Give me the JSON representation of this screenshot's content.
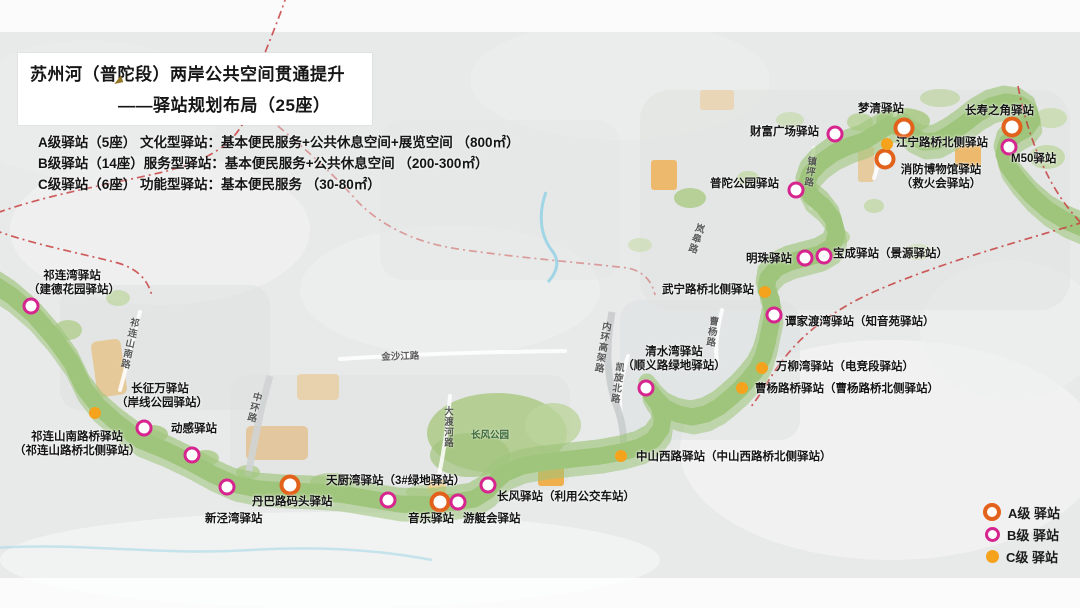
{
  "title": {
    "line1": "苏州河（普陀段）两岸公共空间贯通提升",
    "line2": "——驿站规划布局（25座）"
  },
  "classification": [
    "A级驿站（5座） 文化型驿站：基本便民服务+公共休息空间+展览空间 （800㎡）",
    "B级驿站（14座）服务型驿站：基本便民服务+公共休息空间 （200-300㎡）",
    "C级驿站（6座） 功能型驿站：基本便民服务 （30-80㎡）"
  ],
  "legend": {
    "items": [
      {
        "id": "a",
        "label": "A级 驿站",
        "marker": "ring-orange"
      },
      {
        "id": "b",
        "label": "B级 驿站",
        "marker": "ring-magenta"
      },
      {
        "id": "c",
        "label": "C级 驿站",
        "marker": "dot-amber"
      }
    ]
  },
  "colors": {
    "level_a": "#e2611b",
    "level_b": "#d6258e",
    "level_c": "#f5a21c",
    "boundary": "#c84040",
    "river": "#6cc3de",
    "riverbank": "#9fc57c"
  },
  "stations": [
    {
      "id": "mengqing",
      "level": "a",
      "x": 904,
      "y": 128,
      "label": {
        "x": 858,
        "y": 103,
        "lines": [
          "梦清驿站"
        ]
      }
    },
    {
      "id": "changshou-corner",
      "level": "a",
      "x": 1012,
      "y": 127,
      "label": {
        "x": 965,
        "y": 105,
        "lines": [
          "长寿之角驿站"
        ]
      }
    },
    {
      "id": "fire-museum",
      "level": "a",
      "x": 885,
      "y": 159,
      "label": {
        "x": 893,
        "y": 164,
        "w": 96,
        "align": "center",
        "lines": [
          "消防博物馆驿站",
          "（救火会驿站）"
        ]
      }
    },
    {
      "id": "danba-wharf",
      "level": "a",
      "x": 290,
      "y": 485,
      "label": {
        "x": 252,
        "y": 496,
        "lines": [
          "丹巴路码头驿站"
        ]
      }
    },
    {
      "id": "yinyue",
      "level": "a",
      "x": 440,
      "y": 502,
      "label": {
        "x": 408,
        "y": 513,
        "lines": [
          "音乐驿站"
        ]
      }
    },
    {
      "id": "caifu-plaza",
      "level": "b",
      "x": 835,
      "y": 134,
      "label": {
        "x": 750,
        "y": 126,
        "lines": [
          "财富广场驿站"
        ]
      }
    },
    {
      "id": "m50",
      "level": "b",
      "x": 1009,
      "y": 147,
      "label": {
        "x": 1011,
        "y": 153,
        "lines": [
          "M50驿站"
        ]
      }
    },
    {
      "id": "putuo-park",
      "level": "b",
      "x": 796,
      "y": 190,
      "label": {
        "x": 710,
        "y": 178,
        "lines": [
          "普陀公园驿站"
        ]
      }
    },
    {
      "id": "baocheng",
      "level": "b",
      "x": 824,
      "y": 256,
      "label": {
        "x": 833,
        "y": 248,
        "lines": [
          "宝成驿站（景源驿站）"
        ]
      }
    },
    {
      "id": "mingzhu",
      "level": "b",
      "x": 805,
      "y": 258,
      "label": {
        "x": 746,
        "y": 253,
        "lines": [
          "明珠驿站"
        ]
      }
    },
    {
      "id": "tanjiadu-bay",
      "level": "b",
      "x": 774,
      "y": 315,
      "label": {
        "x": 785,
        "y": 316,
        "lines": [
          "谭家渡湾驿站（知音苑驿站）"
        ]
      }
    },
    {
      "id": "qingshui-bay",
      "level": "b",
      "x": 646,
      "y": 388,
      "label": {
        "x": 622,
        "y": 346,
        "w": 104,
        "align": "center",
        "lines": [
          "清水湾驿站",
          "（顺义路绿地驿站）"
        ]
      }
    },
    {
      "id": "qilian-bay",
      "level": "b",
      "x": 31,
      "y": 306,
      "label": {
        "x": 28,
        "y": 270,
        "w": 88,
        "align": "center",
        "lines": [
          "祁连湾驿站",
          "（建德花园驿站）"
        ]
      }
    },
    {
      "id": "qilianshan-bridge",
      "level": "b",
      "x": 144,
      "y": 428,
      "label": {
        "x": 14,
        "y": 431,
        "w": 126,
        "align": "center",
        "lines": [
          "祁连山南路桥驿站",
          "（祁连山路桥北侧驿站）"
        ]
      }
    },
    {
      "id": "donggan",
      "level": "b",
      "x": 192,
      "y": 455,
      "label": {
        "x": 171,
        "y": 423,
        "lines": [
          "动感驿站"
        ]
      }
    },
    {
      "id": "xinjing-bay",
      "level": "b",
      "x": 227,
      "y": 487,
      "label": {
        "x": 205,
        "y": 513,
        "lines": [
          "新泾湾驿站"
        ]
      }
    },
    {
      "id": "tianchu-bay",
      "level": "b",
      "x": 388,
      "y": 500,
      "label": {
        "x": 326,
        "y": 475,
        "lines": [
          "天厨湾驿站（3#绿地驿站）"
        ]
      }
    },
    {
      "id": "yachting-club",
      "level": "b",
      "x": 458,
      "y": 502,
      "label": {
        "x": 463,
        "y": 513,
        "lines": [
          "游艇会驿站"
        ]
      }
    },
    {
      "id": "changfeng",
      "level": "b",
      "x": 488,
      "y": 485,
      "label": {
        "x": 497,
        "y": 491,
        "lines": [
          "长风驿站（利用公交车站）"
        ]
      }
    },
    {
      "id": "jiangning-bridge-north",
      "level": "c",
      "x": 887,
      "y": 144,
      "label": {
        "x": 896,
        "y": 137,
        "lines": [
          "江宁路桥北侧驿站"
        ]
      }
    },
    {
      "id": "wuning-bridge-north",
      "level": "c",
      "x": 765,
      "y": 292,
      "label": {
        "x": 662,
        "y": 284,
        "lines": [
          "武宁路桥北侧驿站"
        ]
      }
    },
    {
      "id": "wanliu-bay",
      "level": "c",
      "x": 762,
      "y": 368,
      "label": {
        "x": 776,
        "y": 361,
        "lines": [
          "万柳湾驿站（电竞段驿站）"
        ]
      }
    },
    {
      "id": "caoyang-bridge",
      "level": "c",
      "x": 742,
      "y": 388,
      "label": {
        "x": 755,
        "y": 383,
        "lines": [
          "曹杨路桥驿站（曹杨路桥北侧驿站）"
        ]
      }
    },
    {
      "id": "zhongshan-west",
      "level": "c",
      "x": 621,
      "y": 456,
      "label": {
        "x": 636,
        "y": 451,
        "lines": [
          "中山西路驿站（中山西路桥北侧驿站）"
        ]
      }
    },
    {
      "id": "changzheng",
      "level": "c",
      "x": 95,
      "y": 413,
      "label": {
        "x": 116,
        "y": 383,
        "w": 88,
        "align": "center",
        "lines": [
          "长征万驿站",
          "（岸线公园驿站）"
        ]
      }
    }
  ],
  "roads": [
    {
      "id": "qilianshan-south-rd",
      "name": "祁连山南路",
      "x": 127,
      "y": 316,
      "v": true,
      "rot": 12
    },
    {
      "id": "zhonghuan-rd",
      "name": "中环路",
      "x": 250,
      "y": 390,
      "v": true,
      "rot": 14
    },
    {
      "id": "jinshajiang-rd",
      "name": "金沙江路",
      "x": 381,
      "y": 349,
      "v": false,
      "rot": -2
    },
    {
      "id": "daduhe-rd",
      "name": "大渡河路",
      "x": 440,
      "y": 406,
      "v": true,
      "rot": 0
    },
    {
      "id": "changfeng-park",
      "name": "长风公园",
      "x": 471,
      "y": 427,
      "v": false,
      "rot": 0,
      "color": "#2f5d33"
    },
    {
      "id": "neihuan-elevated-rd",
      "name": "内环高架路",
      "x": 599,
      "y": 320,
      "v": true,
      "rot": 10
    },
    {
      "id": "kaixuan-north-rd",
      "name": "凯旋北路",
      "x": 612,
      "y": 361,
      "v": true,
      "rot": 8
    },
    {
      "id": "langao-rd",
      "name": "岚皋路",
      "x": 693,
      "y": 221,
      "v": true,
      "rot": 18
    },
    {
      "id": "caoyang-rd",
      "name": "曹杨路",
      "x": 706,
      "y": 315,
      "v": true,
      "rot": 8
    },
    {
      "id": "zhenping-rd",
      "name": "镇坪路",
      "x": 804,
      "y": 155,
      "v": true,
      "rot": 8
    }
  ]
}
